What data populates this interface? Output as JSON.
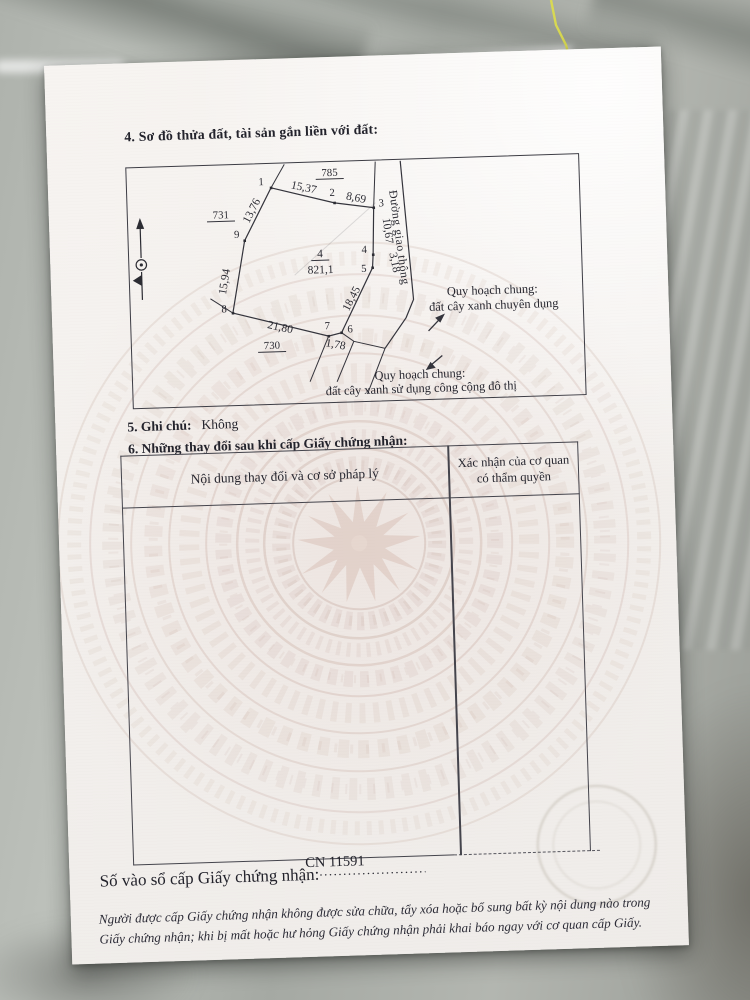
{
  "document": {
    "section4": {
      "title": "4. Sơ đồ thửa đất, tài sản gắn liền với đất:"
    },
    "section5": {
      "label": "5. Ghi chú:",
      "value": "Không"
    },
    "section6": {
      "title": "6. Những thay đổi sau khi cấp Giấy chứng nhận:"
    },
    "changes_table": {
      "col1_header": "Nội dung thay đổi và cơ sở pháp lý",
      "col2_header_line1": "Xác nhận của cơ quan",
      "col2_header_line2": "có thẩm quyền"
    },
    "registry": {
      "label": "Số vào sổ cấp Giấy chứng nhận:",
      "dots": "......................................................",
      "number": "CN 11591"
    },
    "footer_note": {
      "line1": "Người được cấp Giấy chứng nhận không được sửa chữa, tẩy xóa hoặc bổ sung bất kỳ nội dung nào trong",
      "line2": "Giấy chứng nhận; khi bị mất hoặc hư hỏng Giấy chứng nhận phải khai báo ngay với cơ quan cấp Giấy."
    }
  },
  "diagram": {
    "parcel": {
      "number": "4",
      "area": "821,1"
    },
    "adjacent_parcels": {
      "top": "785",
      "left": "731",
      "bottom": "730"
    },
    "road_label": "Đường giao thông",
    "vertices": [
      "1",
      "2",
      "3",
      "4",
      "5",
      "6",
      "7",
      "8",
      "9"
    ],
    "edge_lengths": {
      "e12": "15,37",
      "e23": "8,69",
      "e34": "10,67",
      "e45": "3,18",
      "e56": "18,45",
      "e67": "1,78",
      "e78": "21,80",
      "e89": "15,94",
      "e91": "13,76"
    },
    "planning_note_1": {
      "line1": "Quy hoạch chung:",
      "line2": "đất cây xanh chuyên dụng"
    },
    "planning_note_2": {
      "line1": "Quy hoạch chung:",
      "line2": "đất cây xanh sử dụng công cộng đô thị"
    }
  },
  "colors": {
    "ink": "#2a2a33",
    "paper": "#f4f1ee",
    "watermark": "#c9aea4",
    "marble_crack": "#dede4a"
  }
}
